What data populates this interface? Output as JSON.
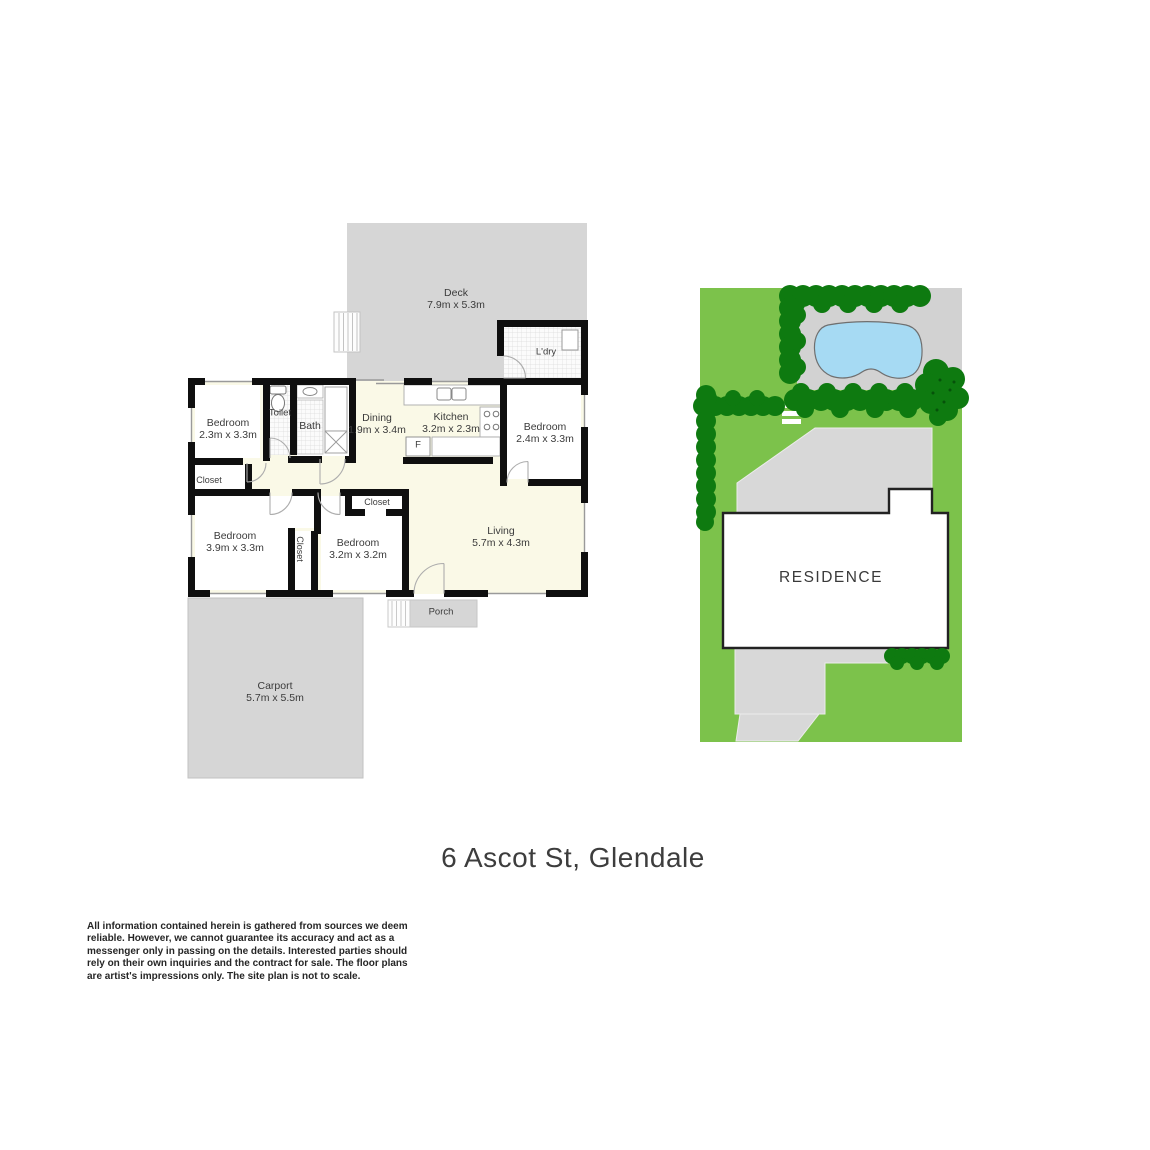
{
  "title": "6 Ascot St, Glendale",
  "floorplan": {
    "rooms": [
      {
        "id": "deck",
        "label": "Deck",
        "dims": "7.9m x 5.3m"
      },
      {
        "id": "laundry",
        "label": "L'dry"
      },
      {
        "id": "bedroom-1",
        "label": "Bedroom",
        "dims": "2.3m x 3.3m"
      },
      {
        "id": "toilet",
        "label": "Toilet"
      },
      {
        "id": "bath",
        "label": "Bath"
      },
      {
        "id": "dining",
        "label": "Dining",
        "dims": "1.9m x 3.4m"
      },
      {
        "id": "kitchen",
        "label": "Kitchen",
        "dims": "3.2m x 2.3m"
      },
      {
        "id": "fridge",
        "label": "F"
      },
      {
        "id": "bedroom-2",
        "label": "Bedroom",
        "dims": "2.4m x 3.3m"
      },
      {
        "id": "closet-1",
        "label": "Closet"
      },
      {
        "id": "bedroom-3",
        "label": "Bedroom",
        "dims": "3.9m x 3.3m"
      },
      {
        "id": "closet-hall",
        "label": "Closet"
      },
      {
        "id": "bedroom-4",
        "label": "Bedroom",
        "dims": "3.2m x 3.2m"
      },
      {
        "id": "closet-2",
        "label": "Closet"
      },
      {
        "id": "living",
        "label": "Living",
        "dims": "5.7m x 4.3m"
      },
      {
        "id": "porch",
        "label": "Porch"
      },
      {
        "id": "carport",
        "label": "Carport",
        "dims": "5.7m x 5.5m"
      }
    ]
  },
  "siteplan": {
    "residence_label": "RESIDENCE"
  },
  "disclaimer": {
    "lines": [
      "All information contained herein is gathered from sources we deem",
      "reliable. However, we cannot guarantee its accuracy and act as a",
      "messenger only in passing on the details. Interested parties should",
      "rely on their own inquiries and the contract for sale. The floor plans",
      "are artist's impressions only. The site plan is not to scale."
    ]
  },
  "colors": {
    "floor_cream": "#faf9e7",
    "wall_black": "#0f0f0f",
    "paving_gray": "#d6d6d6",
    "grass_green": "#7cc24b",
    "hedge_green": "#0e7a10",
    "pool_blue": "#a6daf3"
  }
}
